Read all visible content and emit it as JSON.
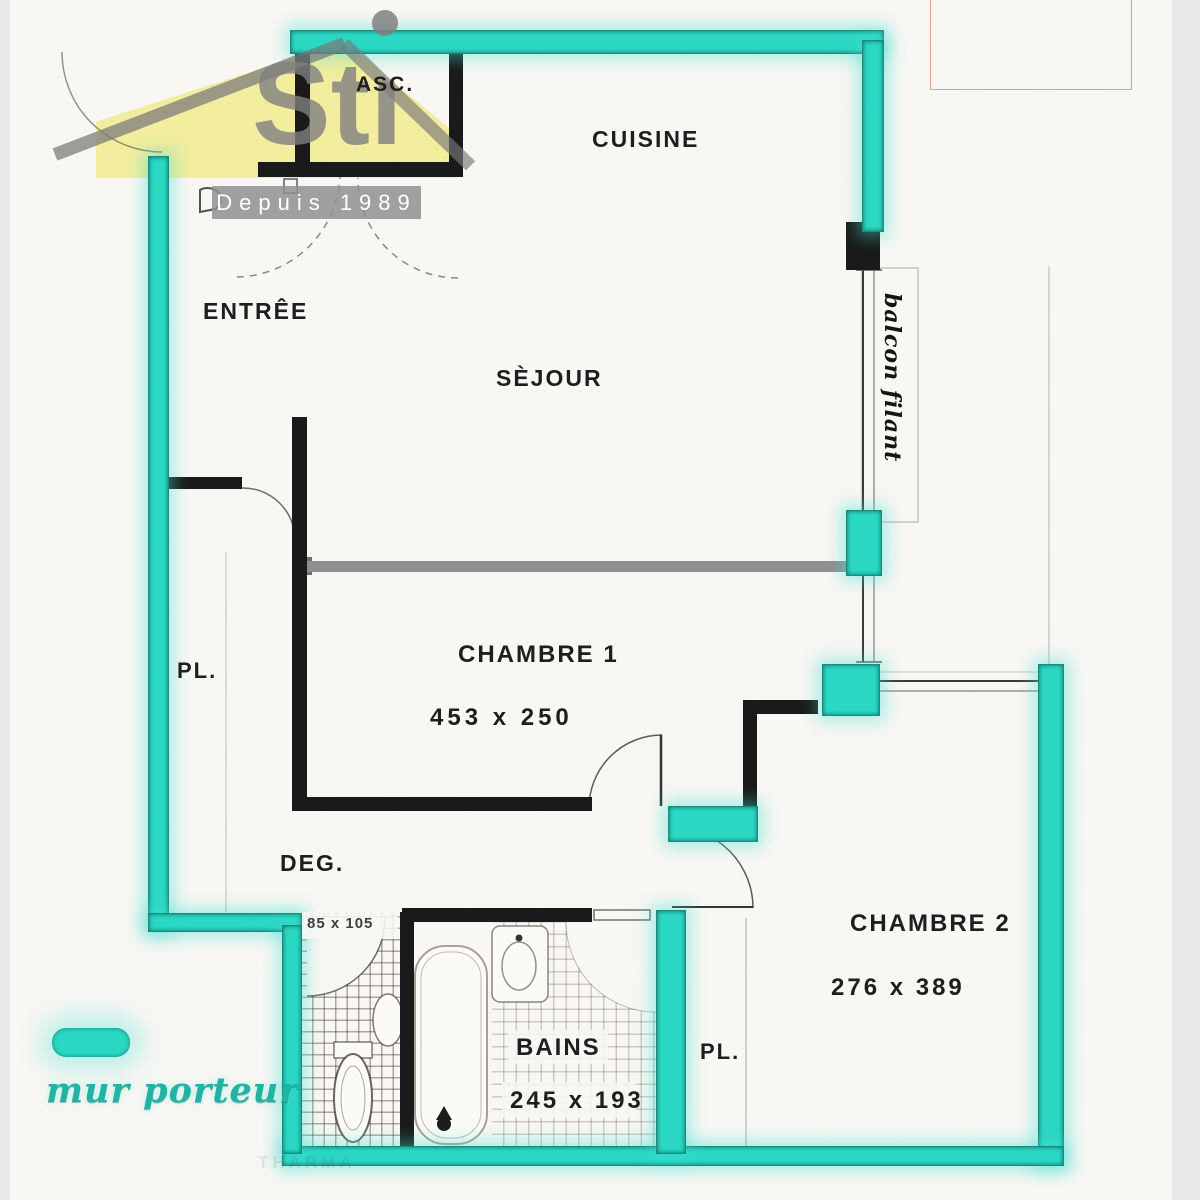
{
  "colors": {
    "teal": "#2bd8c4",
    "teal_text": "#1fb4a4",
    "wall_black": "#1a1a1a",
    "partition_gray": "#8f8f8f",
    "logo_yellow": "#f2ec9b",
    "banner_gray": "#919191",
    "red_outline": "#c45a43"
  },
  "logo": {
    "letters": "Stı",
    "tagline": "Depuis 1989"
  },
  "legend": {
    "label": "mur porteur"
  },
  "rooms": {
    "asc": {
      "label": "ASC."
    },
    "cuisine": {
      "label": "CUISINE"
    },
    "entree": {
      "label": "ENTRÊE"
    },
    "sejour": {
      "label": "SÈJOUR"
    },
    "pl_left": {
      "label": "PL."
    },
    "chambre1": {
      "label": "CHAMBRE 1",
      "dim": "453 x 250"
    },
    "deg": {
      "label": "DEG."
    },
    "chambre2": {
      "label": "CHAMBRE 2",
      "dim": "276 x 389"
    },
    "bains": {
      "label": "BAINS",
      "dim": "245 x 193"
    },
    "pl_right": {
      "label": "PL."
    },
    "wc": {
      "dim": "85 x 105"
    },
    "balcon": {
      "label": "balcon filant"
    }
  },
  "watermark": "THARMA"
}
